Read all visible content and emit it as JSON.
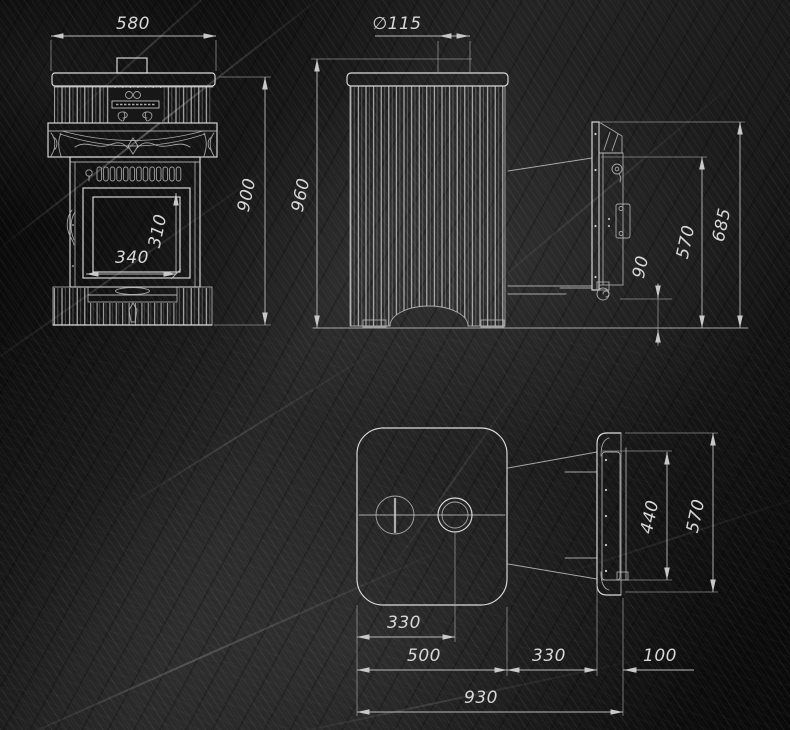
{
  "drawing": {
    "type": "stove technical drawing, three orthographic views",
    "colors": {
      "background": "#1a1a1a",
      "line": "#dcdcdc",
      "dim_line": "#b8b8b8",
      "dim_text": "#d8d8d8"
    }
  },
  "views": {
    "front": {
      "name": "front-view",
      "dims": {
        "width": "580",
        "height": "900",
        "door_width": "340",
        "door_height": "310"
      }
    },
    "side": {
      "name": "side-view",
      "dims": {
        "chimney_diameter": "∅115",
        "height": "960",
        "door_top": "685",
        "opening_top": "570",
        "opening_bottom": "90"
      }
    },
    "plan": {
      "name": "top-view",
      "dims": {
        "chimney_offset": "330",
        "door_inner": "440",
        "door_outer": "570",
        "body_depth": "500",
        "tunnel_length": "330",
        "door_offset": "100",
        "total_depth": "930"
      }
    }
  }
}
